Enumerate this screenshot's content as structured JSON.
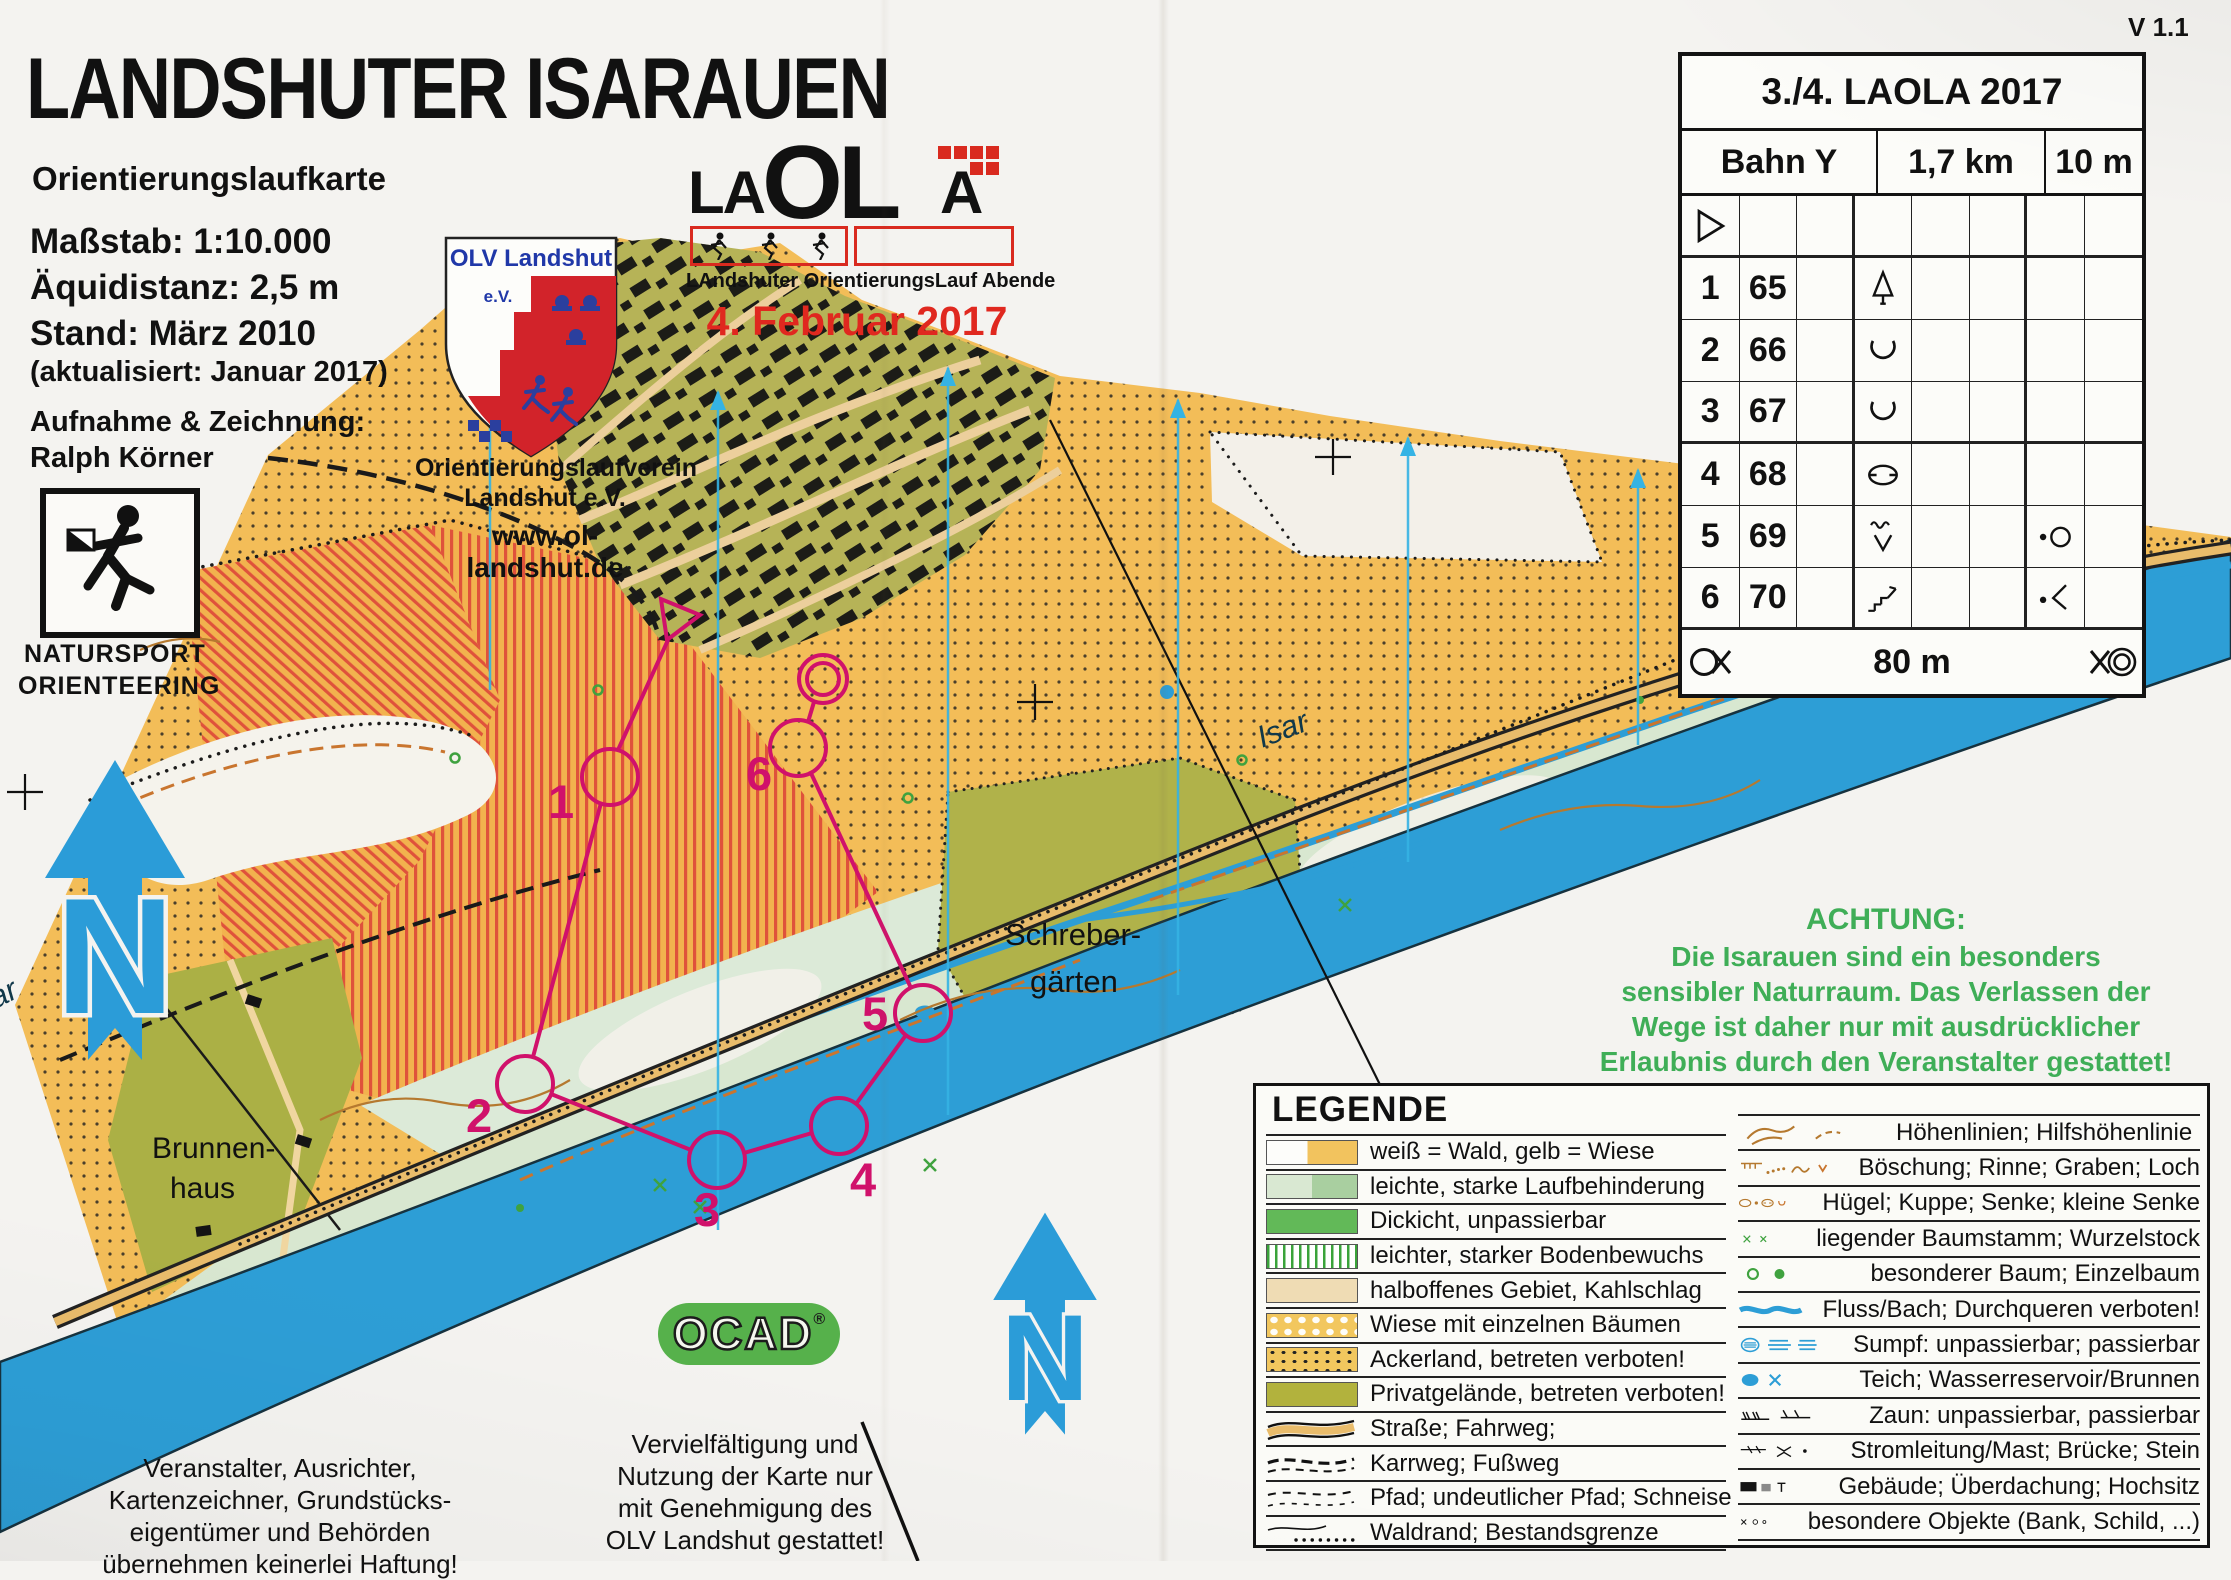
{
  "page": {
    "version": "V 1.1"
  },
  "title_block": {
    "title": "LANDSHUTER ISARAUEN",
    "subtitle": "Orientierungslaufkarte",
    "scale": "Maßstab: 1:10.000",
    "equidistance": "Äquidistanz: 2,5 m",
    "stand": "Stand: März 2010",
    "updated": "(aktualisiert: Januar 2017)",
    "credit_label": "Aufnahme & Zeichnung:",
    "credit_name": "Ralph Körner"
  },
  "natursport": {
    "line1": "NATURSPORT",
    "line2": "ORIENTEERING"
  },
  "club": {
    "crest_name": "OLV Landshut",
    "crest_ev": "e.V.",
    "org_line1": "Orientierungslaufverein",
    "org_line2": "Landshut e.V.",
    "website": "www.ol-landshut.de"
  },
  "laola": {
    "part_la": "LA",
    "part_ol": "OL",
    "part_a": "A",
    "subtitle": "LAndshuter OrientierungsLauf Abende",
    "date": "4. Februar 2017"
  },
  "control_card": {
    "title": "3./4. LAOLA 2017",
    "course": "Bahn Y",
    "length": "1,7 km",
    "climb": "10 m",
    "rows": [
      {
        "num": "",
        "code": "",
        "symbol_d": "start-triangle",
        "symbol_g": ""
      },
      {
        "num": "1",
        "code": "65",
        "symbol_d": "distinctive-tree",
        "symbol_g": ""
      },
      {
        "num": "2",
        "code": "66",
        "symbol_d": "reentrant",
        "symbol_g": ""
      },
      {
        "num": "3",
        "code": "67",
        "symbol_d": "reentrant",
        "symbol_g": ""
      },
      {
        "num": "4",
        "code": "68",
        "symbol_d": "depression",
        "symbol_g": ""
      },
      {
        "num": "5",
        "code": "69",
        "symbol_d": "marsh-reentrant",
        "symbol_g": "dot-circle"
      },
      {
        "num": "6",
        "code": "70",
        "symbol_d": "steps-bank",
        "symbol_g": "dot-bend"
      }
    ],
    "footer": {
      "distance": "80 m",
      "left_symbol": "start-taped-route",
      "right_symbol": "finish-double-circle"
    }
  },
  "achtung": {
    "heading": "ACHTUNG:",
    "lines": [
      "Die Isarauen sind ein besonders",
      "sensibler Naturraum. Das Verlassen der",
      "Wege ist daher nur mit ausdrücklicher",
      "Erlaubnis durch den Veranstalter gestattet!"
    ]
  },
  "legend": {
    "title": "LEGENDE",
    "left": [
      {
        "label": "weiß = Wald, gelb = Wiese",
        "swatch": "white-yellow"
      },
      {
        "label": "leichte, starke Laufbehinderung",
        "swatch": "light-green-two-tone"
      },
      {
        "label": "Dickicht, unpassierbar",
        "swatch": "dark-green"
      },
      {
        "label": "leichter, starker Bodenbewuchs",
        "swatch": "green-stripes"
      },
      {
        "label": "halboffenes Gebiet, Kahlschlag",
        "swatch": "pale-tan"
      },
      {
        "label": "Wiese mit einzelnen Bäumen",
        "swatch": "yellow-white-dots"
      },
      {
        "label": "Ackerland, betreten verboten!",
        "swatch": "yellow-black-dots"
      },
      {
        "label": "Privatgelände, betreten verboten!",
        "swatch": "olive"
      },
      {
        "label": "Straße; Fahrweg;",
        "swatch": "road"
      },
      {
        "label": "Karrweg; Fußweg",
        "swatch": "track"
      },
      {
        "label": "Pfad; undeutlicher Pfad; Schneise",
        "swatch": "path-dashes"
      },
      {
        "label": "Waldrand; Bestandsgrenze",
        "swatch": "forest-edge"
      }
    ],
    "right": [
      {
        "label": "Höhenlinien; Hilfshöhenlinie",
        "symbol": "contours"
      },
      {
        "label": "Böschung; Rinne; Graben; Loch",
        "symbol": "earth-bank-gully"
      },
      {
        "label": "Hügel; Kuppe; Senke; kleine Senke",
        "symbol": "knoll-depression"
      },
      {
        "label": "liegender Baumstamm; Wurzelstock",
        "symbol": "fallen-tree"
      },
      {
        "label": "besonderer Baum; Einzelbaum",
        "symbol": "special-tree"
      },
      {
        "label": "Fluss/Bach; Durchqueren verboten!",
        "symbol": "river"
      },
      {
        "label": "Sumpf: unpassierbar; passierbar",
        "symbol": "marsh"
      },
      {
        "label": "Teich; Wasserreservoir/Brunnen",
        "symbol": "pond-well"
      },
      {
        "label": "Zaun: unpassierbar, passierbar",
        "symbol": "fence"
      },
      {
        "label": "Stromleitung/Mast; Brücke; Stein",
        "symbol": "powerline-bridge-stone"
      },
      {
        "label": "Gebäude; Überdachung; Hochsitz",
        "symbol": "building-canopy"
      },
      {
        "label": "besondere Objekte (Bank, Schild, ...)",
        "symbol": "special-objects"
      }
    ]
  },
  "map": {
    "labels": {
      "schreber_line1": "Schreber-",
      "schreber_line2": "gärten",
      "brunnen_line1": "Brunnen-",
      "brunnen_line2": "haus",
      "river": "Isar",
      "river_edge": "Isar"
    },
    "north_label": "N",
    "course_labels": [
      "1",
      "2",
      "3",
      "4",
      "5",
      "6"
    ]
  },
  "ocad": {
    "name": "OCAD",
    "reg": "®"
  },
  "disclaimer_left": {
    "lines": [
      "Veranstalter, Ausrichter,",
      "Kartenzeichner, Grundstücks-",
      "eigentümer und Behörden",
      "übernehmen keinerlei Haftung!"
    ]
  },
  "disclaimer_center": {
    "lines": [
      "Vervielfältigung und",
      "Nutzung der Karte nur",
      "mit Genehmigung des",
      "OLV Landshut gestattet!"
    ]
  },
  "colors": {
    "course_magenta": "#d0116b",
    "river_blue": "#2d9ed6",
    "warning_green": "#3fae57",
    "date_red": "#e0281f",
    "terrain_yellow": "#f3bd58"
  }
}
